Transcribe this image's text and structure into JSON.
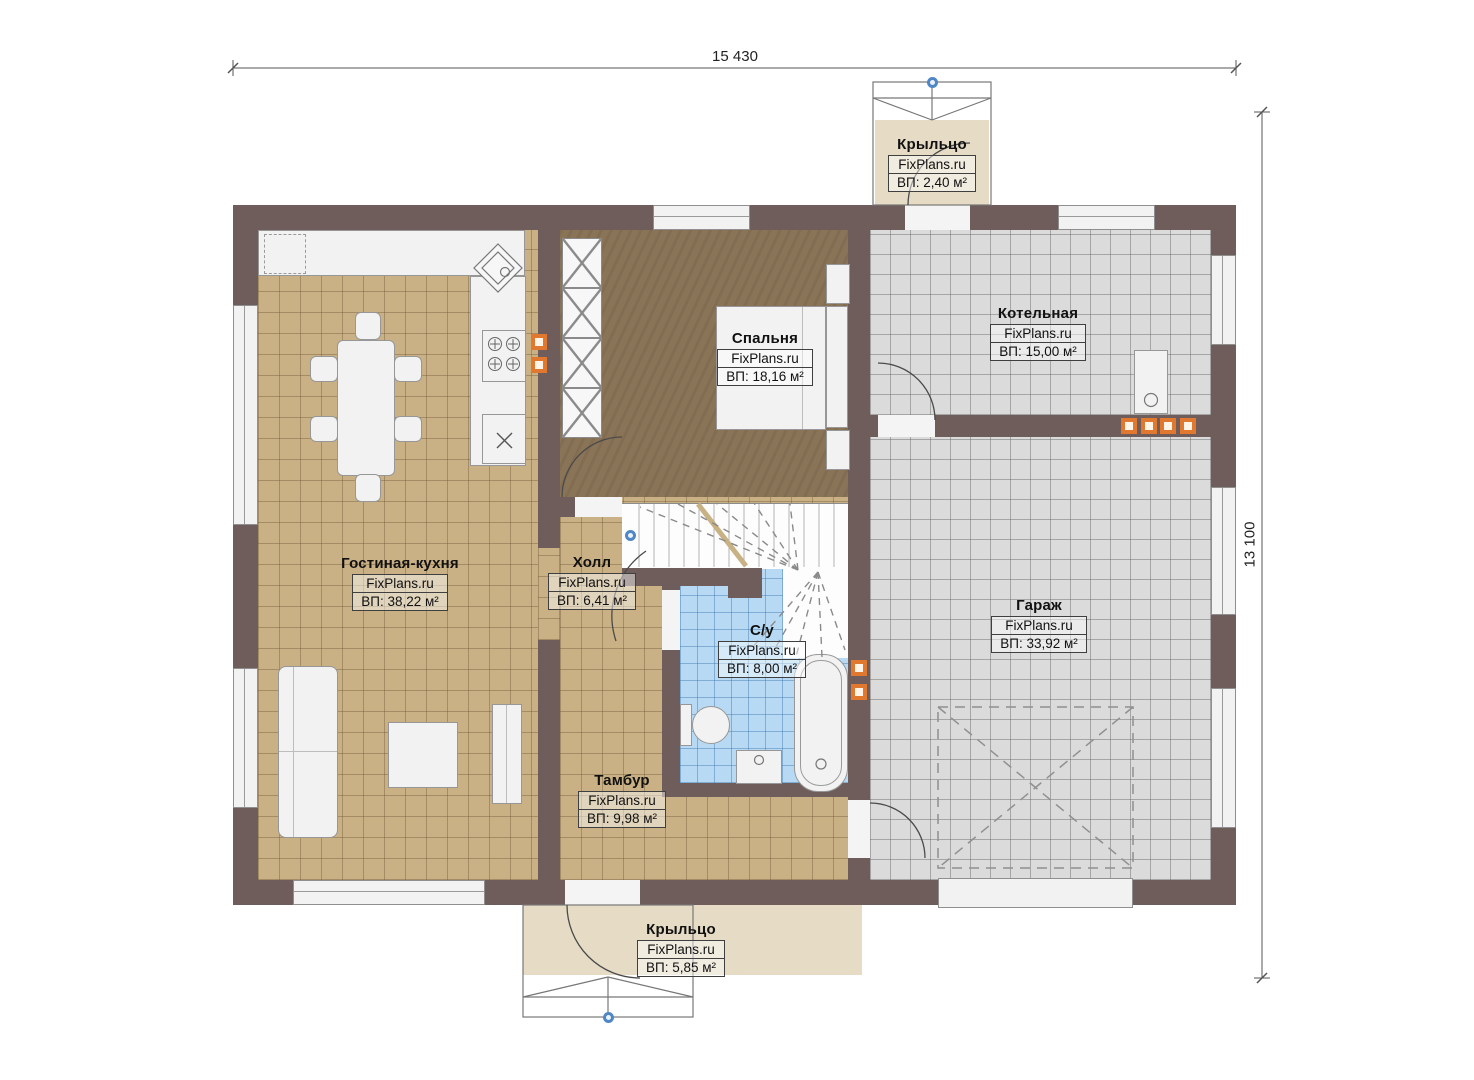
{
  "dimensions": {
    "horizontal": "15 430",
    "vertical": "13 100"
  },
  "rooms": [
    {
      "key": "porch-top",
      "name": "Крыльцо",
      "brand": "FixPlans.ru",
      "area": "ВП: 2,40 м²"
    },
    {
      "key": "bedroom",
      "name": "Спальня",
      "brand": "FixPlans.ru",
      "area": "ВП: 18,16 м²"
    },
    {
      "key": "boiler-room",
      "name": "Котельная",
      "brand": "FixPlans.ru",
      "area": "ВП: 15,00 м²"
    },
    {
      "key": "living-kitchen",
      "name": "Гостиная-кухня",
      "brand": "FixPlans.ru",
      "area": "ВП: 38,22 м²"
    },
    {
      "key": "hall",
      "name": "Холл",
      "brand": "FixPlans.ru",
      "area": "ВП: 6,41 м²"
    },
    {
      "key": "bathroom",
      "name": "С/у",
      "brand": "FixPlans.ru",
      "area": "ВП: 8,00 м²"
    },
    {
      "key": "garage",
      "name": "Гараж",
      "brand": "FixPlans.ru",
      "area": "ВП: 33,92 м²"
    },
    {
      "key": "vestibule",
      "name": "Тамбур",
      "brand": "FixPlans.ru",
      "area": "ВП: 9,98 м²"
    },
    {
      "key": "porch-bottom",
      "name": "Крыльцо",
      "brand": "FixPlans.ru",
      "area": "ВП: 5,85 м²"
    }
  ],
  "colors": {
    "wall": "#6f5d5b",
    "floor_tan": "#c9b185",
    "floor_brown": "#8a7457",
    "floor_gray": "#dbdbdb",
    "floor_blue": "#b7d9f3",
    "porch": "#e6dcc6",
    "vent_orange": "#e0792f",
    "marker_blue": "#4f86c6"
  }
}
